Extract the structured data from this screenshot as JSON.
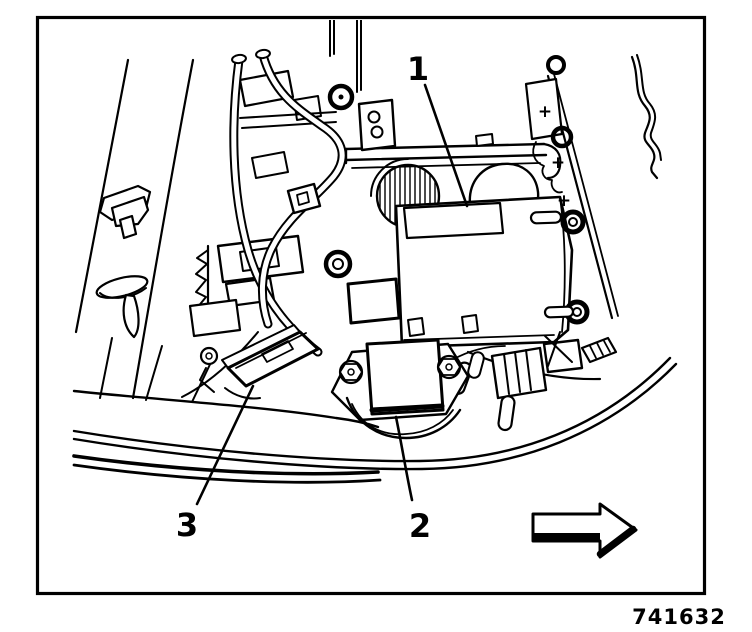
{
  "figure": {
    "number": "741632"
  },
  "callouts": [
    {
      "label": "1"
    },
    {
      "label": "2"
    },
    {
      "label": "3"
    }
  ],
  "markers": {
    "plus": "+"
  },
  "direction_arrow": {
    "direction": "right"
  },
  "colors": {
    "ink": "#000000",
    "paper": "#ffffff"
  }
}
